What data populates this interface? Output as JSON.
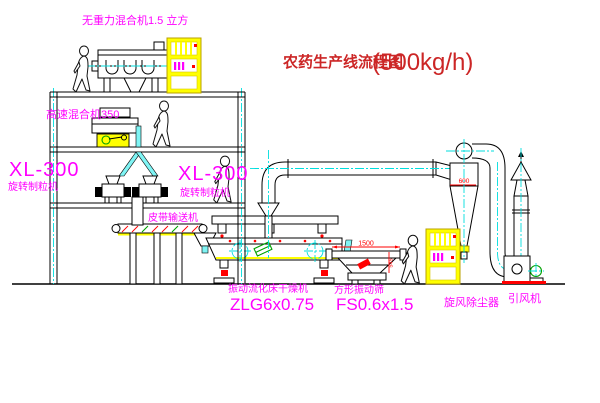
{
  "title": {
    "text": "农药生产线流程图",
    "capacity": "(500kg/h)"
  },
  "equipment_labels": {
    "gravity_mixer": "无重力混合机1.5 立方",
    "high_speed_mixer": "高速混合机350",
    "granulator_left_model": "XL-300",
    "granulator_left_name": "旋转制粒机",
    "granulator_right_model": "XL-300",
    "granulator_right_name": "旋转制粒机",
    "belt_conveyor": "皮带输送机",
    "dryer_name": "振动流化床干燥机",
    "dryer_model": "ZLG6x0.75",
    "sieve_name": "方形振动筛",
    "sieve_model": "FS0.6x1.5",
    "cyclone_name": "旋风除尘器",
    "fan_name": "引风机"
  },
  "dimensions": {
    "sieve_length": "1500",
    "sieve_height": "545",
    "cyclone_width": "600"
  },
  "colors": {
    "label_magenta": "#ff00ff",
    "title_red": "#cc2626",
    "accent_red": "#ff0000",
    "centerline_cyan": "#00dede",
    "highlight_yellow": "#ffff00",
    "motor_green": "#00a000",
    "line_black": "#000000"
  }
}
